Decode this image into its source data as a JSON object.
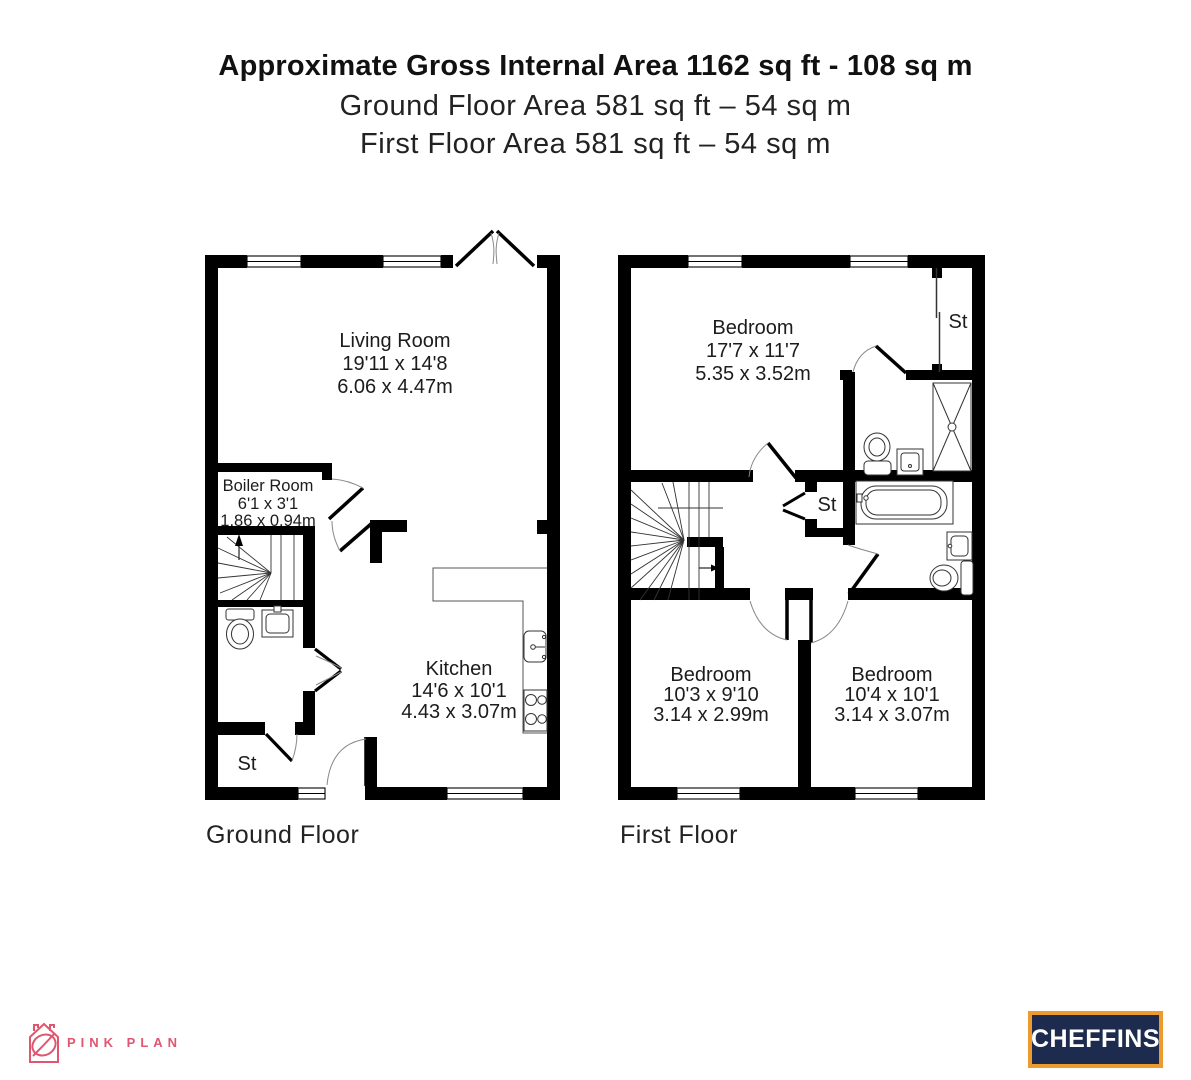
{
  "title": {
    "line1": "Approximate Gross Internal Area 1162 sq ft - 108 sq m",
    "line2": "Ground Floor Area 581 sq ft – 54 sq m",
    "line3": "First Floor Area 581 sq ft – 54 sq m"
  },
  "ground_floor": {
    "label": "Ground Floor",
    "rooms": {
      "living_room": {
        "name": "Living Room",
        "imperial": "19'11 x 14'8",
        "metric": "6.06 x 4.47m"
      },
      "boiler_room": {
        "name": "Boiler Room",
        "imperial": "6'1 x 3'1",
        "metric": "1.86 x 0.94m"
      },
      "kitchen": {
        "name": "Kitchen",
        "imperial": "14'6 x 10'1",
        "metric": "4.43 x 3.07m"
      },
      "store": {
        "name": "St"
      }
    }
  },
  "first_floor": {
    "label": "First Floor",
    "rooms": {
      "bedroom_main": {
        "name": "Bedroom",
        "imperial": "17'7 x 11'7",
        "metric": "5.35 x 3.52m"
      },
      "bedroom_left": {
        "name": "Bedroom",
        "imperial": "10'3 x 9'10",
        "metric": "3.14 x 2.99m"
      },
      "bedroom_right": {
        "name": "Bedroom",
        "imperial": "10'4 x 10'1",
        "metric": "3.14 x 3.07m"
      },
      "store_top": {
        "name": "St"
      },
      "store_landing": {
        "name": "St"
      }
    }
  },
  "branding": {
    "pink_plan": {
      "text": "PINK PLAN",
      "color": "#e0566f"
    },
    "cheffins": {
      "text": "CHEFFINS",
      "bg": "#1d2c4e",
      "border": "#ef9a2d",
      "text_color": "#ffffff"
    }
  }
}
